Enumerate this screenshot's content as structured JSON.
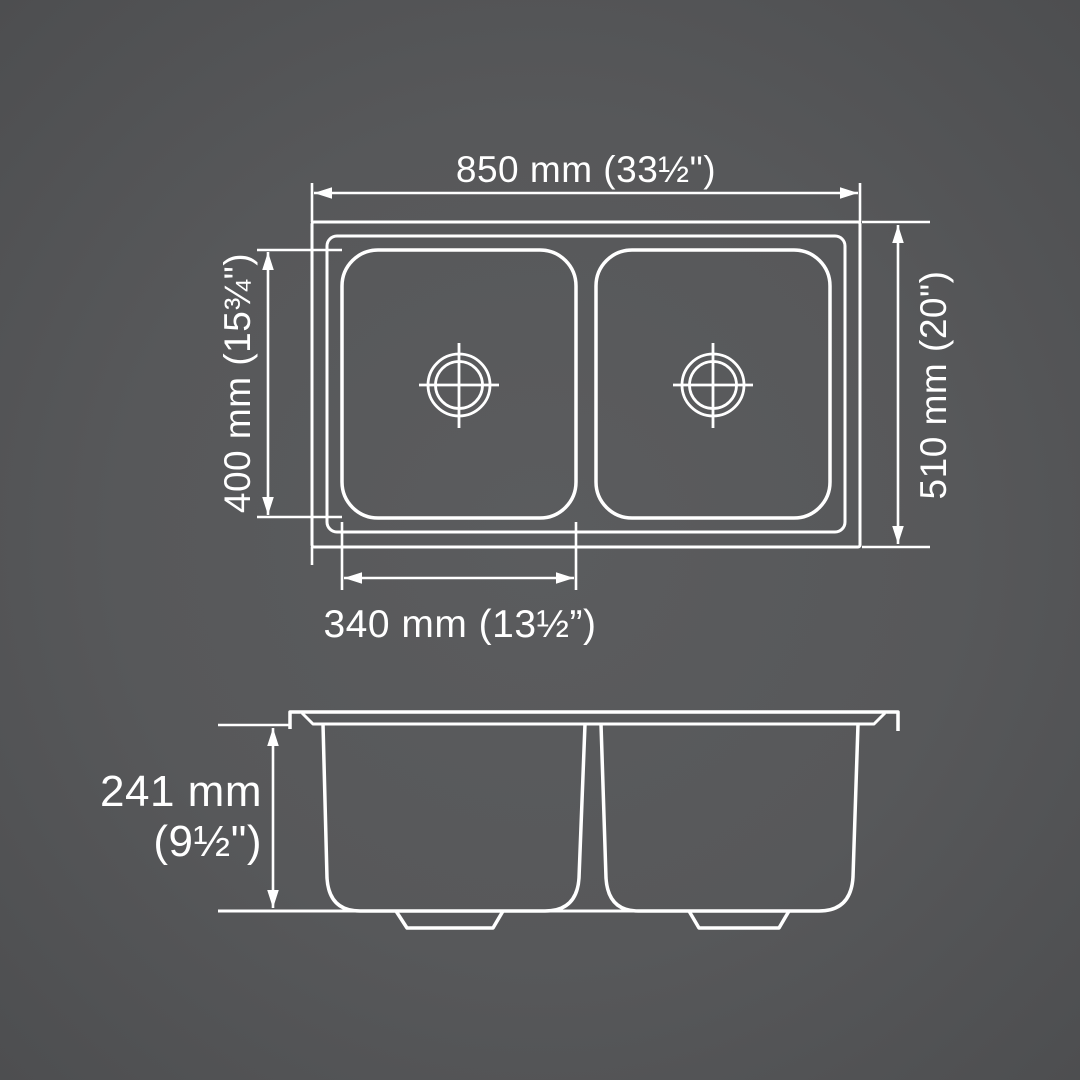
{
  "diagram": {
    "kind": "technical-drawing",
    "subject": "double-bowl kitchen sink dimension diagram",
    "colors": {
      "background": "#58595b",
      "line": "#ffffff"
    },
    "dims": {
      "overall_width": "850 mm (33½\")",
      "overall_depth": "510 mm (20\")",
      "bowl_depth": "400 mm (15¾\")",
      "bowl_width": "340 mm (13½”)",
      "bowl_height_mm": "241 mm",
      "bowl_height_in": "(9½\")"
    },
    "values": {
      "overall_width_mm": 850,
      "overall_depth_mm": 510,
      "bowl_depth_mm": 400,
      "bowl_width_mm": 340,
      "bowl_height_mm": 241
    }
  }
}
